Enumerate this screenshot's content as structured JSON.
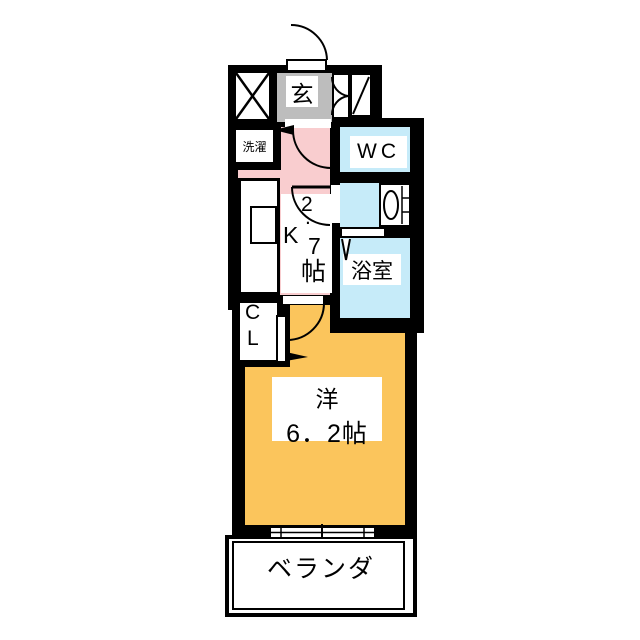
{
  "rooms": {
    "entrance": {
      "label": "玄"
    },
    "laundry": {
      "label": "洗濯"
    },
    "toilet": {
      "label": "WC"
    },
    "bathroom": {
      "label": "浴室"
    },
    "kitchen": {
      "chars": [
        "2",
        ".",
        "K",
        "7",
        "帖"
      ],
      "reading": "K2.7帖"
    },
    "closet": {
      "chars": [
        "C",
        "L"
      ]
    },
    "western_room": {
      "name": "洋",
      "size": "6．2帖"
    },
    "veranda": {
      "label": "ベランダ"
    }
  },
  "colors": {
    "wall": "#000000",
    "kitchen_floor": "#F9CDCF",
    "western_room_floor": "#FBC55C",
    "wet_area_floor": "#C6EBF9",
    "entrance_floor": "#BDBDBD",
    "background": "#FFFFFF"
  }
}
